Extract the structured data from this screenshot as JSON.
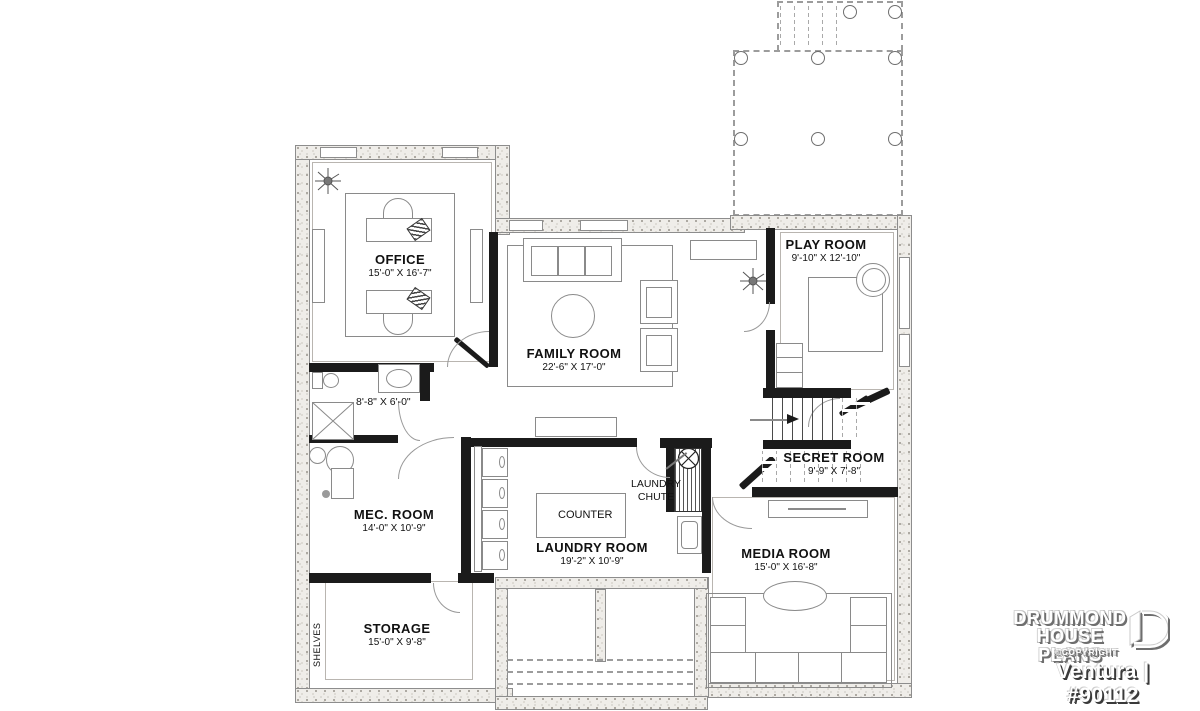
{
  "plan": {
    "rooms": {
      "office": {
        "name": "OFFICE",
        "dims": "15'-0\" X 16'-7\""
      },
      "family": {
        "name": "FAMILY ROOM",
        "dims": "22'-6\" X 17'-0\""
      },
      "play": {
        "name": "PLAY ROOM",
        "dims": "9'-10\" X 12'-10\""
      },
      "secret": {
        "name": "SECRET ROOM",
        "dims": "9'-9\" X 7'-8\""
      },
      "mec": {
        "name": "MEC. ROOM",
        "dims": "14'-0\" X 10'-9\""
      },
      "laundry": {
        "name": "LAUNDRY ROOM",
        "dims": "19'-2\" X 10'-9\""
      },
      "media": {
        "name": "MEDIA ROOM",
        "dims": "15'-0\" X 16'-8\""
      },
      "storage": {
        "name": "STORAGE",
        "dims": "15'-0\" X 9'-8\""
      },
      "bath": {
        "dims": "8'-8\" X 6'-0\""
      }
    },
    "annotations": {
      "counter": "COUNTER",
      "laundry_chute_line1": "LAUNDRY",
      "laundry_chute_line2": "CHUTE",
      "shelves": "SHELVES"
    }
  },
  "branding": {
    "name_line1": "DRUMMOND",
    "name_line2": "HOUSE PLANS",
    "copyright": "©COPYRIGHT",
    "plan_id": "Ventura | #90112"
  },
  "colors": {
    "interior_wall": "#1b1b1b",
    "concrete_wall": "#efede9",
    "line": "#8a8a8a"
  }
}
